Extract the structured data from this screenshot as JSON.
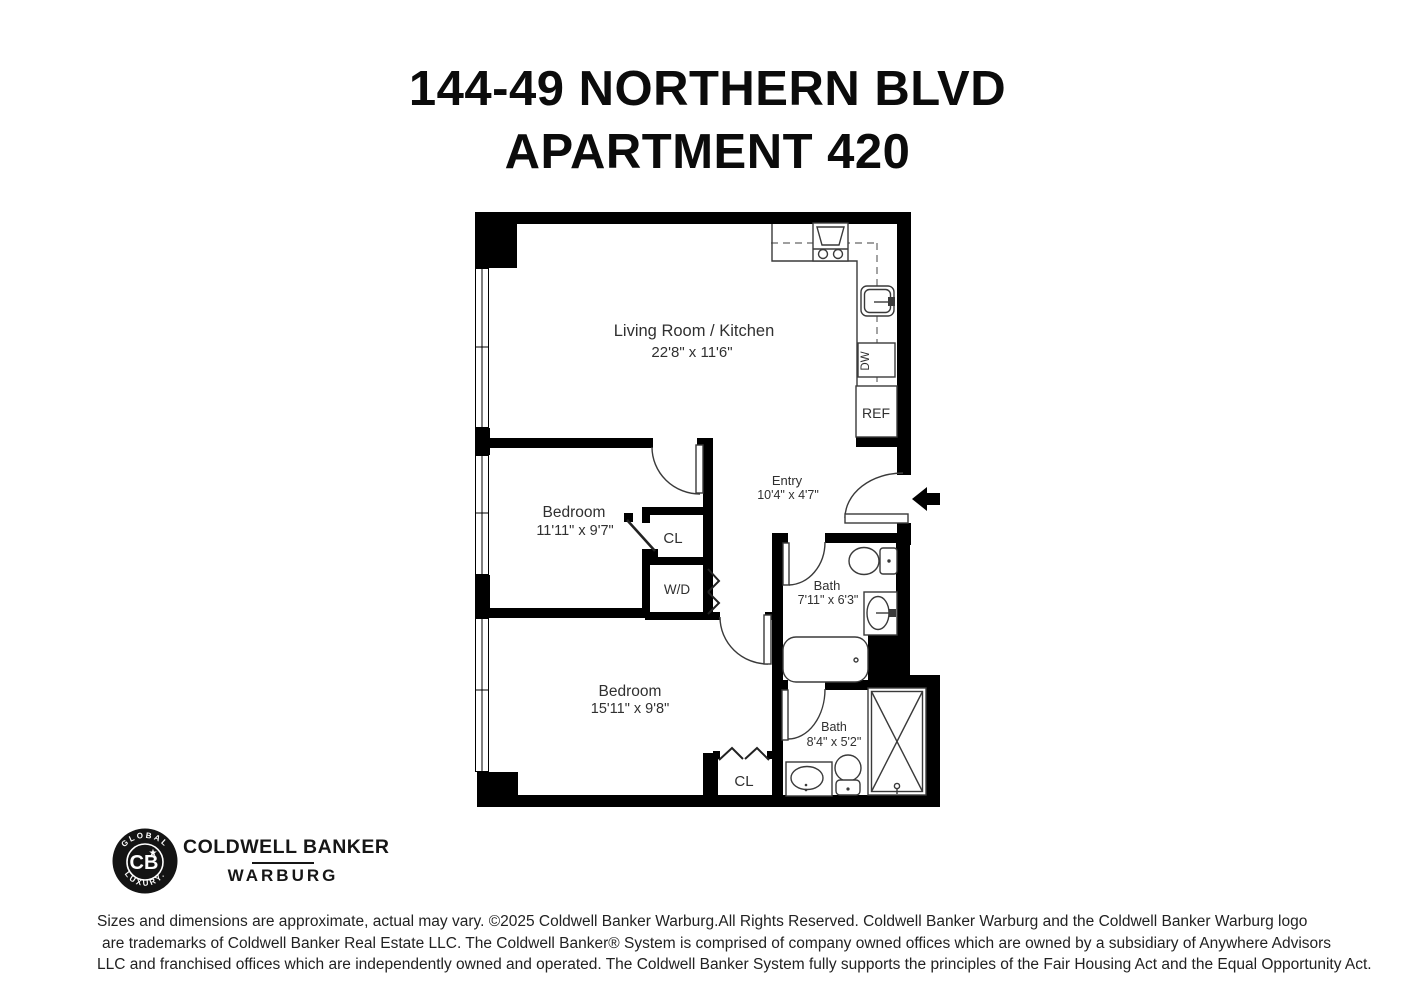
{
  "title": {
    "line1": "144-49 NORTHERN BLVD",
    "line2": "APARTMENT 420"
  },
  "rooms": {
    "living": {
      "name": "Living Room / Kitchen",
      "dims": "22'8\" x 11'6\""
    },
    "bedroom1": {
      "name": "Bedroom",
      "dims": "11'11\" x 9'7\""
    },
    "bedroom2": {
      "name": "Bedroom",
      "dims": "15'11\" x 9'8\""
    },
    "entry": {
      "name": "Entry",
      "dims": "10'4\" x 4'7\""
    },
    "bath1": {
      "name": "Bath",
      "dims": "7'11\" x 6'3\""
    },
    "bath2": {
      "name": "Bath",
      "dims": "8'4\" x 5'2\""
    }
  },
  "fixtures": {
    "closet1": "CL",
    "closet2": "CL",
    "washer_dryer": "W/D",
    "dishwasher": "DW",
    "refrigerator": "REF"
  },
  "branding": {
    "badge_top": "GLOBAL",
    "badge_bottom": "LUXURY.",
    "monogram": "CB",
    "star": "★",
    "line1": "COLDWELL BANKER",
    "line2": "WARBURG"
  },
  "disclaimer": {
    "line1": "Sizes and dimensions are approximate, actual may vary. ©2025 Coldwell Banker Warburg.All Rights Reserved. Coldwell Banker Warburg and the Coldwell Banker Warburg logo",
    "line2": "are trademarks of Coldwell Banker Real Estate LLC. The Coldwell Banker® System is comprised of company owned offices which are owned by a subsidiary of Anywhere Advisors",
    "line3": "LLC and franchised offices which are independently owned and operated. The Coldwell Banker System fully supports the principles of the Fair Housing Act and the Equal Opportunity Act."
  },
  "colors": {
    "wall": "#000000",
    "fixture_stroke": "#3a3a3a",
    "label_text": "#303030",
    "background": "#ffffff"
  }
}
